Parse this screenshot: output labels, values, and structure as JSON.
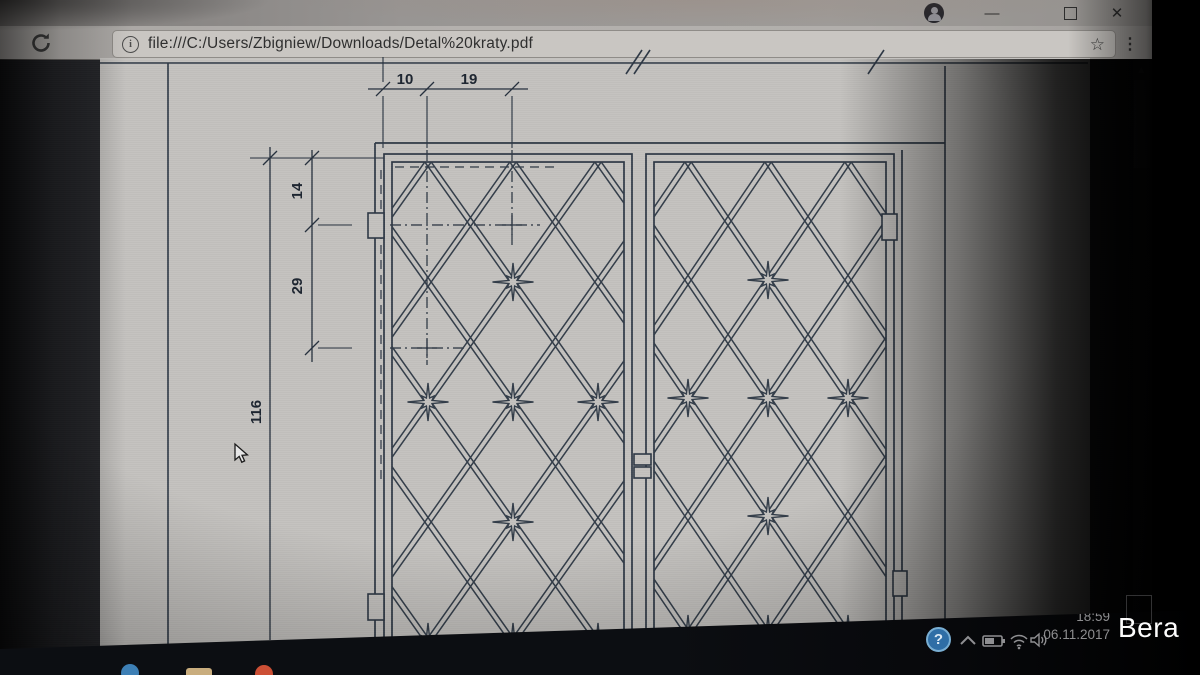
{
  "browser": {
    "titlebar": {
      "minimize_glyph": "—",
      "close_glyph": "✕"
    },
    "toolbar": {
      "reload_icon": "reload-arrow",
      "info_glyph": "i",
      "url": "file:///C:/Users/Zbigniew/Downloads/Detal%20kraty.pdf",
      "star_glyph": "☆",
      "menu_glyph": "⋮"
    },
    "scrollbar_up_glyph": "▲"
  },
  "pdf": {
    "dimensions": {
      "d10": "10",
      "d19": "19",
      "d14": "14",
      "d29": "29",
      "d116": "116"
    }
  },
  "taskbar": {
    "help_glyph": "?",
    "chevron_icon": "chevron-up",
    "battery_icon": "battery",
    "wifi_icon": "wifi",
    "volume_icon": "speaker",
    "time": "18:59",
    "date": "06.11.2017"
  },
  "watermark": "Bera",
  "colors": {
    "line": "#333d49",
    "page": "#c4c2bf",
    "help_blue": "#2f6ea6"
  }
}
